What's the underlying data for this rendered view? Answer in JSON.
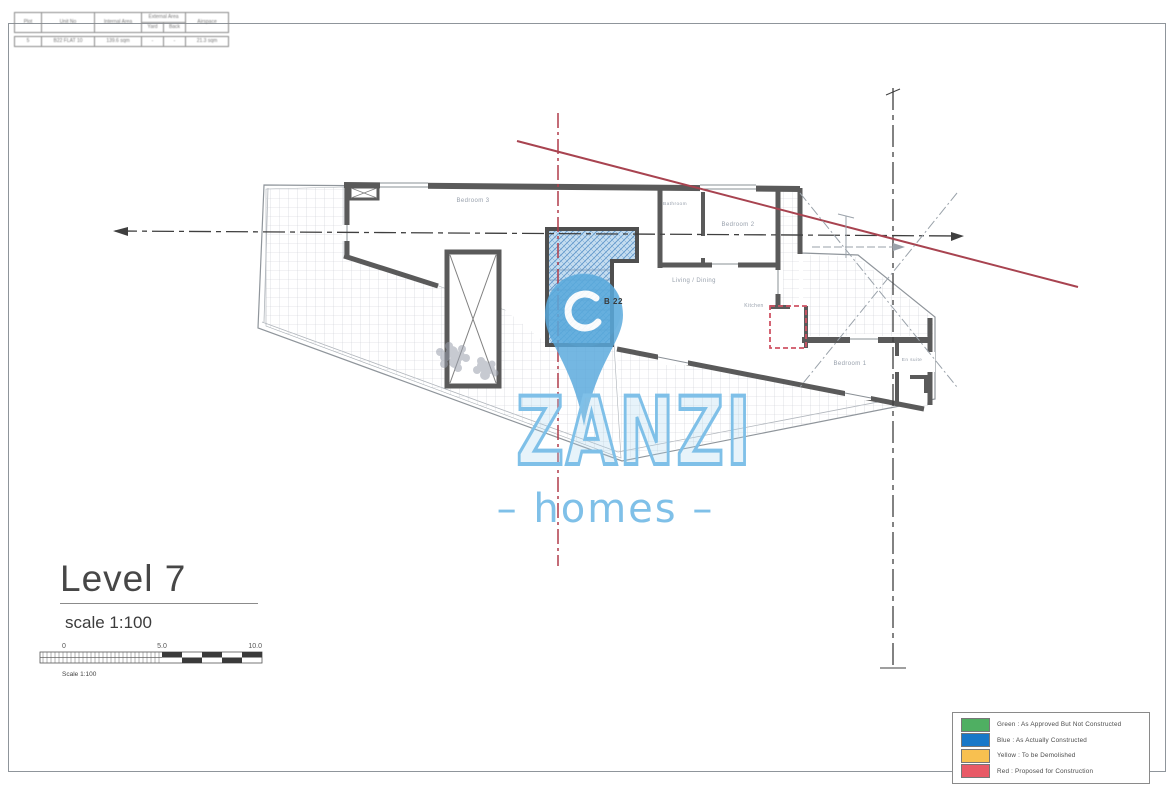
{
  "sheet": {
    "title_block": {
      "headers": {
        "plot": "Plot",
        "unit_no": "Unit No",
        "internal_area": "Internal Area",
        "external_group": "External Area",
        "sub_left": "Yard",
        "sub_right": "Back",
        "airspace": "Airspace"
      },
      "values": {
        "plot": "5",
        "unit_no": "B22 FLAT 10",
        "internal_area": "139.6 sqm",
        "sub_left": "-",
        "sub_right": "-",
        "airspace": "21.3 sqm"
      }
    },
    "level_title": "Level 7",
    "scale_label": "scale 1:100",
    "scale_bar": {
      "tick_0": "0",
      "tick_5": "5.0",
      "tick_10": "10.0",
      "caption": "Scale 1:100"
    },
    "watermark": {
      "brand": "ZANZI",
      "sub": "– homes –",
      "color": "#7fc0e8"
    },
    "plan": {
      "block_label": "B 22",
      "rooms": [
        {
          "label": "Bedroom 3"
        },
        {
          "label": "Bathroom"
        },
        {
          "label": "Bedroom 2"
        },
        {
          "label": "Living / Dining"
        },
        {
          "label": "Kitchen"
        },
        {
          "label": "Bedroom 1"
        },
        {
          "label": "En suite"
        }
      ]
    },
    "legend": {
      "items": [
        {
          "color": "#4faf62",
          "label": "Green : As Approved But Not Constructed"
        },
        {
          "color": "#1878c8",
          "label": "Blue : As Actually Constructed"
        },
        {
          "color": "#f8c050",
          "label": "Yellow : To be Demolished"
        },
        {
          "color": "#e85a67",
          "label": "Red : Proposed for Construction"
        }
      ]
    }
  }
}
